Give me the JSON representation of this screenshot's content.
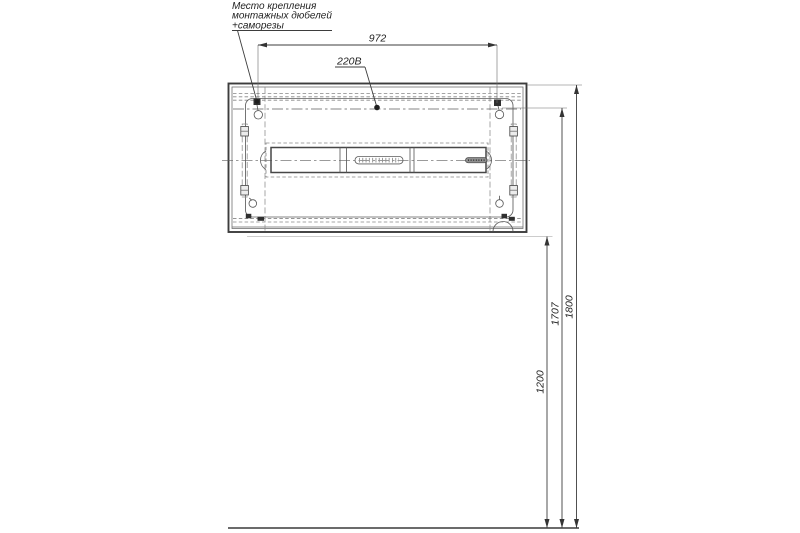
{
  "note": {
    "line1": "Место крепления",
    "line2": "монтажных дюбелей",
    "line3": "+саморезы"
  },
  "power_label": "220В",
  "dimensions": {
    "width": "972",
    "total_height": "1800",
    "holes_height": "1707",
    "bottom_height": "1200"
  },
  "colors": {
    "line": "#3d3d3d",
    "thin_line": "#6a6a6a",
    "dashed_line": "#8a8a8a",
    "text": "#1f1f1f",
    "background": "#ffffff"
  }
}
